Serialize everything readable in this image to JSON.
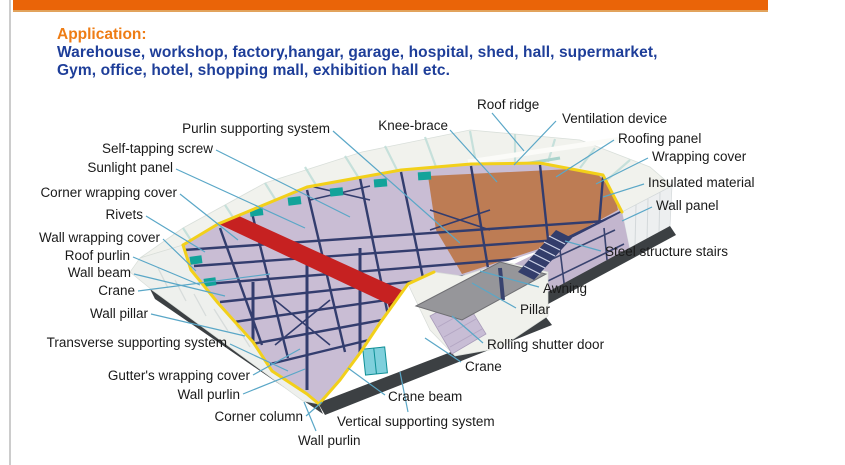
{
  "application": {
    "heading": "Application:",
    "line1": "Warehouse, workshop, factory,hangar, garage, hospital, shed, hall, supermarket,",
    "line2": "Gym, office, hotel, shopping mall, exhibition hall etc."
  },
  "palette": {
    "top_bar": "#ea6408",
    "top_bar_under": "#e2a35c",
    "heading": "#ee7d15",
    "body_text": "#1e3e99",
    "label_text": "#1a1a1a",
    "leader_line": "#5aa7c7",
    "frame_navy": "#333d6e",
    "cutaway_edge_yellow": "#f2d01a",
    "floor_lavender": "#c9bdd4",
    "ceiling_tan": "#bd7c54",
    "crane_red": "#c62121",
    "panel_white": "#f1f2ed",
    "panel_stripe": "#bfded8",
    "teal_accent": "#12a39a",
    "base_dark": "#3c4043",
    "awning_gray": "#96969a"
  },
  "diagram": {
    "subject": "steel-structure-warehouse-cutaway",
    "labels": [
      {
        "text": "Purlin supporting system",
        "align": "right",
        "x": 330,
        "y": 129,
        "line": [
          333,
          131,
          460,
          243
        ]
      },
      {
        "text": "Knee-brace",
        "align": "right",
        "x": 448,
        "y": 126,
        "line": [
          450,
          130,
          497,
          182
        ]
      },
      {
        "text": "Self-tapping screw",
        "align": "right",
        "x": 213,
        "y": 149,
        "line": [
          216,
          150,
          350,
          217
        ]
      },
      {
        "text": "Sunlight panel",
        "align": "right",
        "x": 173,
        "y": 168,
        "line": [
          176,
          169,
          305,
          228
        ]
      },
      {
        "text": "Corner wrapping cover",
        "align": "right",
        "x": 177,
        "y": 193,
        "line": [
          180,
          194,
          238,
          240
        ]
      },
      {
        "text": "Rivets",
        "align": "right",
        "x": 143,
        "y": 215,
        "line": [
          146,
          216,
          205,
          252
        ]
      },
      {
        "text": "Wall wrapping cover",
        "align": "right",
        "x": 160,
        "y": 238,
        "line": [
          163,
          239,
          196,
          271
        ]
      },
      {
        "text": "Roof purlin",
        "align": "right",
        "x": 130,
        "y": 256,
        "line": [
          133,
          257,
          200,
          285
        ]
      },
      {
        "text": "Wall beam",
        "align": "right",
        "x": 131,
        "y": 273,
        "line": [
          134,
          274,
          225,
          296
        ]
      },
      {
        "text": "Crane",
        "align": "right",
        "x": 135,
        "y": 291,
        "line": [
          138,
          291,
          270,
          274
        ]
      },
      {
        "text": "Wall pillar",
        "align": "right",
        "x": 148,
        "y": 314,
        "line": [
          151,
          314,
          245,
          336
        ]
      },
      {
        "text": "Transverse supporting system",
        "align": "right",
        "x": 227,
        "y": 343,
        "line": [
          230,
          344,
          288,
          371
        ]
      },
      {
        "text": "Gutter's wrapping cover",
        "align": "right",
        "x": 250,
        "y": 376,
        "line": [
          253,
          375,
          300,
          349
        ]
      },
      {
        "text": "Wall purlin",
        "align": "right",
        "x": 240,
        "y": 395,
        "line": [
          243,
          394,
          305,
          369
        ]
      },
      {
        "text": "Corner column",
        "align": "right",
        "x": 303,
        "y": 417,
        "line": [
          306,
          416,
          322,
          402
        ]
      },
      {
        "text": "Wall purlin",
        "align": "left",
        "x": 298,
        "y": 441,
        "line": [
          316,
          431,
          304,
          402
        ]
      },
      {
        "text": "Vertical supporting system",
        "align": "left",
        "x": 337,
        "y": 422,
        "line": [
          408,
          412,
          400,
          372
        ]
      },
      {
        "text": "Crane beam",
        "align": "left",
        "x": 388,
        "y": 397,
        "line": [
          385,
          395,
          348,
          368
        ]
      },
      {
        "text": "Crane",
        "align": "left",
        "x": 465,
        "y": 367,
        "line": [
          461,
          362,
          425,
          338
        ]
      },
      {
        "text": "Rolling shutter door",
        "align": "left",
        "x": 487,
        "y": 345,
        "line": [
          483,
          343,
          452,
          316
        ]
      },
      {
        "text": "Pillar",
        "align": "left",
        "x": 520,
        "y": 310,
        "line": [
          516,
          308,
          472,
          283
        ]
      },
      {
        "text": "Awning",
        "align": "left",
        "x": 543,
        "y": 289,
        "line": [
          539,
          287,
          480,
          271
        ]
      },
      {
        "text": "Steel structure stairs",
        "align": "left",
        "x": 605,
        "y": 252,
        "line": [
          601,
          251,
          565,
          241
        ]
      },
      {
        "text": "Wall panel",
        "align": "left",
        "x": 656,
        "y": 206,
        "line": [
          652,
          207,
          622,
          221
        ]
      },
      {
        "text": "Insulated material",
        "align": "left",
        "x": 648,
        "y": 183,
        "line": [
          644,
          184,
          603,
          197
        ]
      },
      {
        "text": "Wrapping cover",
        "align": "left",
        "x": 652,
        "y": 157,
        "line": [
          648,
          158,
          596,
          184
        ]
      },
      {
        "text": "Roofing panel",
        "align": "left",
        "x": 618,
        "y": 139,
        "line": [
          614,
          140,
          556,
          177
        ]
      },
      {
        "text": "Ventilation device",
        "align": "left",
        "x": 562,
        "y": 119,
        "line": [
          556,
          121,
          514,
          165
        ]
      },
      {
        "text": "Roof ridge",
        "align": "left",
        "x": 477,
        "y": 105,
        "line": [
          492,
          113,
          524,
          151
        ]
      }
    ]
  }
}
